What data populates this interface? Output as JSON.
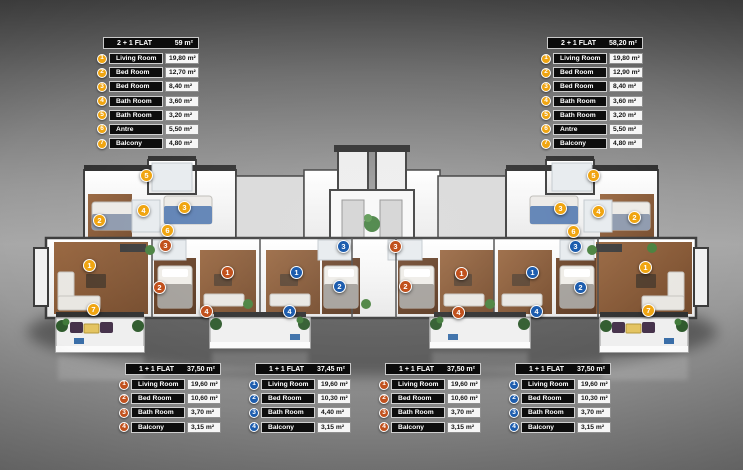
{
  "colors": {
    "yellow": "#f0a511",
    "orange": "#c1511d",
    "blue": "#1d5dae",
    "header_bg": "#0b0b0b",
    "label_bg": "#0d0d0d",
    "value_bg": "#f6f6f6"
  },
  "tables": [
    {
      "name": "flat-2plus1-left",
      "position": "top-left",
      "title": "2 + 1 FLAT",
      "area": "59 m²",
      "accent": "yellow",
      "rows": [
        {
          "num": "1",
          "label": "Living Room",
          "value": "19,80 m²"
        },
        {
          "num": "2",
          "label": "Bed Room",
          "value": "12,70 m²"
        },
        {
          "num": "3",
          "label": "Bed Room",
          "value": "8,40 m²"
        },
        {
          "num": "4",
          "label": "Bath Room",
          "value": "3,60 m²"
        },
        {
          "num": "5",
          "label": "Bath Room",
          "value": "3,20 m²"
        },
        {
          "num": "6",
          "label": "Antre",
          "value": "5,50 m²"
        },
        {
          "num": "7",
          "label": "Balcony",
          "value": "4,80 m²"
        }
      ]
    },
    {
      "name": "flat-2plus1-right",
      "position": "top-right",
      "title": "2 + 1 FLAT",
      "area": "58,20 m²",
      "accent": "yellow",
      "rows": [
        {
          "num": "1",
          "label": "Living Room",
          "value": "19,80 m²"
        },
        {
          "num": "2",
          "label": "Bed Room",
          "value": "12,90 m²"
        },
        {
          "num": "3",
          "label": "Bed Room",
          "value": "8,40 m²"
        },
        {
          "num": "4",
          "label": "Bath Room",
          "value": "3,60 m²"
        },
        {
          "num": "5",
          "label": "Bath Room",
          "value": "3,20 m²"
        },
        {
          "num": "6",
          "label": "Antre",
          "value": "5,50 m²"
        },
        {
          "num": "7",
          "label": "Balcony",
          "value": "4,80 m²"
        }
      ]
    },
    {
      "name": "flat-1plus1-a",
      "position": "bottom-1",
      "title": "1 + 1 FLAT",
      "area": "37,50 m²",
      "accent": "orange",
      "rows": [
        {
          "num": "1",
          "label": "Living Room",
          "value": "19,60 m²"
        },
        {
          "num": "2",
          "label": "Bed Room",
          "value": "10,60 m²"
        },
        {
          "num": "3",
          "label": "Bath Room",
          "value": "3,70 m²"
        },
        {
          "num": "4",
          "label": "Balcony",
          "value": "3,15 m²"
        }
      ]
    },
    {
      "name": "flat-1plus1-b",
      "position": "bottom-2",
      "title": "1 + 1 FLAT",
      "area": "37,45 m²",
      "accent": "blue",
      "rows": [
        {
          "num": "1",
          "label": "Living Room",
          "value": "19,60 m²"
        },
        {
          "num": "2",
          "label": "Bed Room",
          "value": "10,30 m²"
        },
        {
          "num": "3",
          "label": "Bath Room",
          "value": "4,40 m²"
        },
        {
          "num": "4",
          "label": "Balcony",
          "value": "3,15 m²"
        }
      ]
    },
    {
      "name": "flat-1plus1-c",
      "position": "bottom-3",
      "title": "1 + 1 FLAT",
      "area": "37,50 m²",
      "accent": "orange",
      "rows": [
        {
          "num": "1",
          "label": "Living Room",
          "value": "19,60 m²"
        },
        {
          "num": "2",
          "label": "Bed Room",
          "value": "10,60 m²"
        },
        {
          "num": "3",
          "label": "Bath Room",
          "value": "3,70 m²"
        },
        {
          "num": "4",
          "label": "Balcony",
          "value": "3,15 m²"
        }
      ]
    },
    {
      "name": "flat-1plus1-d",
      "position": "bottom-4",
      "title": "1 + 1 FLAT",
      "area": "37,50 m²",
      "accent": "blue",
      "rows": [
        {
          "num": "1",
          "label": "Living Room",
          "value": "19,60 m²"
        },
        {
          "num": "2",
          "label": "Bed Room",
          "value": "10,30 m²"
        },
        {
          "num": "3",
          "label": "Bath Room",
          "value": "3,70 m²"
        },
        {
          "num": "4",
          "label": "Balcony",
          "value": "3,15 m²"
        }
      ]
    }
  ],
  "plan": {
    "flats": [
      {
        "name": "flat-2plus1-left",
        "accent": "yellow",
        "markers": [
          {
            "num": "1",
            "x": 90,
            "y": 266
          },
          {
            "num": "2",
            "x": 100,
            "y": 221
          },
          {
            "num": "3",
            "x": 185,
            "y": 208
          },
          {
            "num": "4",
            "x": 144,
            "y": 211
          },
          {
            "num": "5",
            "x": 147,
            "y": 176
          },
          {
            "num": "6",
            "x": 168,
            "y": 231
          },
          {
            "num": "7",
            "x": 94,
            "y": 310
          }
        ]
      },
      {
        "name": "flat-1plus1-a",
        "accent": "orange",
        "markers": [
          {
            "num": "1",
            "x": 228,
            "y": 273
          },
          {
            "num": "2",
            "x": 160,
            "y": 288
          },
          {
            "num": "3",
            "x": 166,
            "y": 246
          },
          {
            "num": "4",
            "x": 207,
            "y": 312
          }
        ]
      },
      {
        "name": "flat-1plus1-b",
        "accent": "blue",
        "markers": [
          {
            "num": "1",
            "x": 297,
            "y": 273
          },
          {
            "num": "2",
            "x": 340,
            "y": 287
          },
          {
            "num": "3",
            "x": 344,
            "y": 247
          },
          {
            "num": "4",
            "x": 290,
            "y": 312
          }
        ]
      },
      {
        "name": "flat-1plus1-c",
        "accent": "orange",
        "markers": [
          {
            "num": "1",
            "x": 462,
            "y": 274
          },
          {
            "num": "2",
            "x": 406,
            "y": 287
          },
          {
            "num": "3",
            "x": 396,
            "y": 247
          },
          {
            "num": "4",
            "x": 459,
            "y": 313
          }
        ]
      },
      {
        "name": "flat-1plus1-d",
        "accent": "blue",
        "markers": [
          {
            "num": "1",
            "x": 533,
            "y": 273
          },
          {
            "num": "2",
            "x": 581,
            "y": 288
          },
          {
            "num": "3",
            "x": 576,
            "y": 247
          },
          {
            "num": "4",
            "x": 537,
            "y": 312
          }
        ]
      },
      {
        "name": "flat-2plus1-right",
        "accent": "yellow",
        "markers": [
          {
            "num": "1",
            "x": 646,
            "y": 268
          },
          {
            "num": "2",
            "x": 635,
            "y": 218
          },
          {
            "num": "3",
            "x": 561,
            "y": 209
          },
          {
            "num": "4",
            "x": 599,
            "y": 212
          },
          {
            "num": "5",
            "x": 594,
            "y": 176
          },
          {
            "num": "6",
            "x": 574,
            "y": 232
          },
          {
            "num": "7",
            "x": 649,
            "y": 311
          }
        ]
      }
    ]
  }
}
